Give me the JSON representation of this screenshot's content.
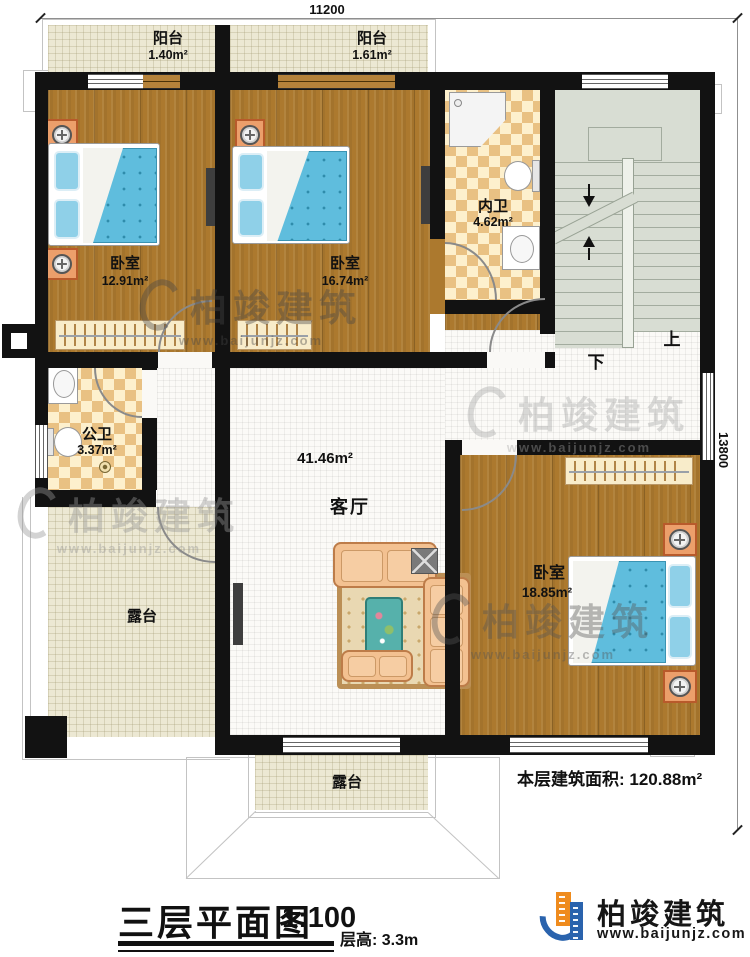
{
  "dimensions": {
    "width_mm": "11200",
    "height_mm": "13800"
  },
  "rooms": {
    "balcony1": {
      "name": "阳台",
      "area": "1.40m²"
    },
    "balcony2": {
      "name": "阳台",
      "area": "1.61m²"
    },
    "bedroom1": {
      "name": "卧室",
      "area": "12.91m²"
    },
    "bedroom2": {
      "name": "卧室",
      "area": "16.74m²"
    },
    "bedroom3": {
      "name": "卧室",
      "area": "18.85m²"
    },
    "ensuite_bath": {
      "name": "内卫",
      "area": "4.62m²"
    },
    "public_bath": {
      "name": "公卫",
      "area": "3.37m²"
    },
    "living_room": {
      "name": "客厅",
      "area": "41.46m²"
    },
    "terrace_left": {
      "name": "露台"
    },
    "terrace_bottom": {
      "name": "露台"
    }
  },
  "stairs": {
    "up": "上",
    "down": "下"
  },
  "notes": {
    "floor_area": "本层建筑面积: 120.88m²"
  },
  "title_block": {
    "title": "三层平面图",
    "scale": "1:100",
    "floor_height": "层高: 3.3m"
  },
  "brand": {
    "name": "柏竣建筑",
    "website": "www.baijunjz.com"
  },
  "watermark": {
    "name": "柏竣建筑",
    "website": "www.baijunjz.com"
  },
  "colors": {
    "wall": "#121212",
    "wood_floor": "#ac792e",
    "balcony_terrace": "#ece8d3",
    "bath_checker": "#e9c183",
    "stairs": "#d8ddd3",
    "bed_blue": "#5fbddd",
    "nightstand_orange": "#ec9f6b",
    "sofa_tan": "#f3c191",
    "brand_blue": "#2a63ad",
    "brand_orange": "#ef8b1d"
  }
}
